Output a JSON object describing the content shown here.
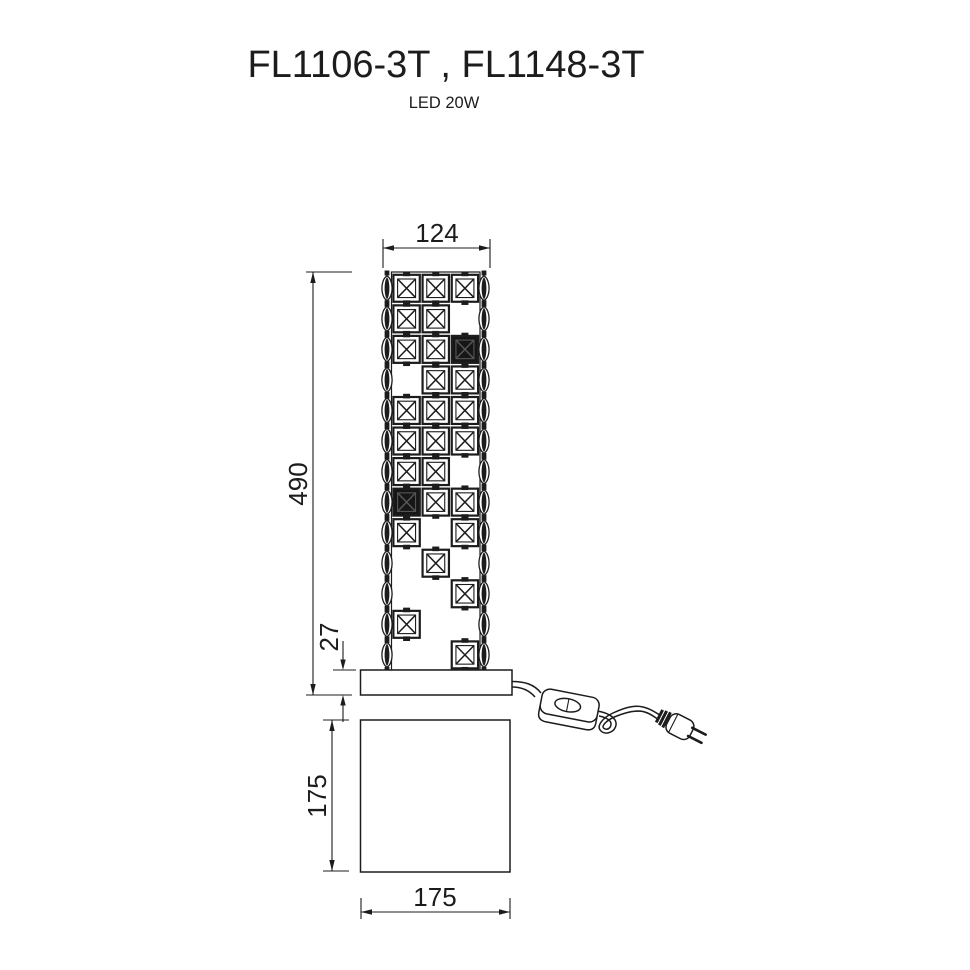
{
  "title": "FL1106-3T , FL1148-3T",
  "subtitle": "LED 20W",
  "colors": {
    "line": "#1c1c1c",
    "background": "#ffffff"
  },
  "dimensions": {
    "shade_width": "124",
    "total_height": "490",
    "plate_height": "27",
    "base_height": "175",
    "base_width": "175"
  },
  "lamp": {
    "grid_legend": {
      "0": "empty",
      "1": "clear-crystal",
      "2": "dark-crystal"
    },
    "grid": [
      "111",
      "110",
      "112",
      "011",
      "111",
      "111",
      "110",
      "211",
      "101",
      "010",
      "001",
      "100",
      "001"
    ],
    "columns": 3,
    "rows": 13,
    "beads_per_chain": 13,
    "chains": [
      "left",
      "right"
    ]
  },
  "accessories": {
    "switch": "inline-cord-switch",
    "plug": "two-pin-power-plug"
  }
}
